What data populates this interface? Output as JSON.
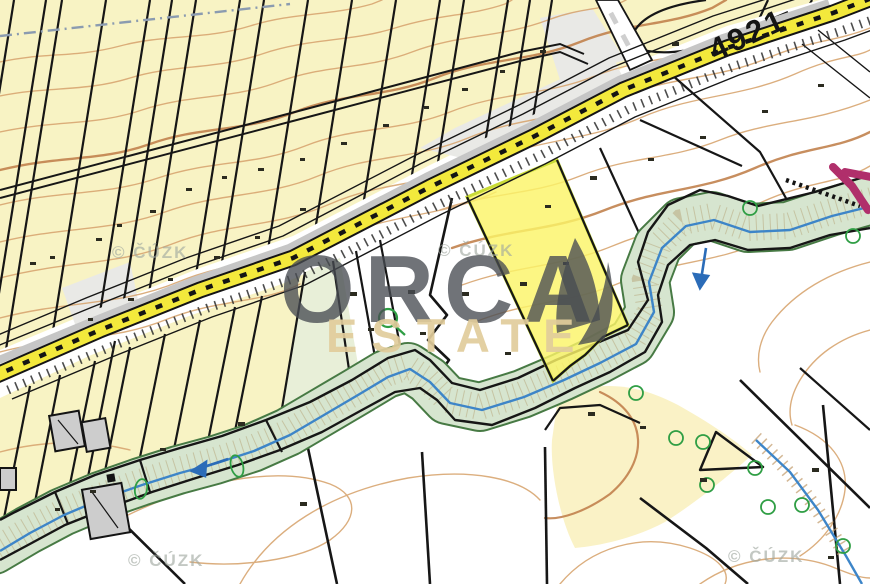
{
  "map": {
    "road_label": "4921",
    "copyright_label": "© ČÚZK",
    "watermark": {
      "brand": "ORCA",
      "suffix": "ESTATE"
    },
    "colors": {
      "farmland": "#f8f3c4",
      "farmland_pale": "#e8efd8",
      "riparian_corridor": "#d6e5cf",
      "riparian_edge": "#477a44",
      "stream": "#3d85c8",
      "road_fill": "#f3e93c",
      "road_casing": "#141414",
      "access_road": "#b02f6b",
      "contour": "#d8a671",
      "contour_index": "#c2824e",
      "highlighted_parcel_fill": "#fbf468",
      "highlighted_parcel_border": "#c9db36",
      "building": "#cdcdcd"
    }
  }
}
